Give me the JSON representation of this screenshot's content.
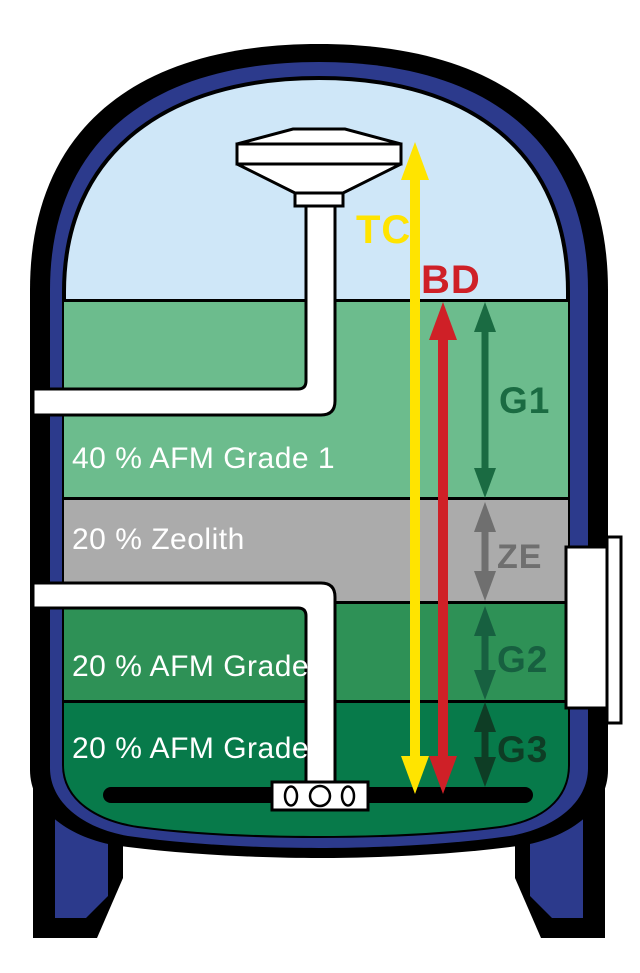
{
  "labels": {
    "tc": "TC",
    "bd": "BD",
    "g1": "G1",
    "ze": "ZE",
    "g2": "G2",
    "g3": "G3"
  },
  "layers": [
    {
      "caption": "40 % AFM Grade 1",
      "tag": "G1"
    },
    {
      "caption": "20 % Zeolith",
      "tag": "ZE"
    },
    {
      "caption": "20 % AFM Grade 2",
      "tag": "G2"
    },
    {
      "caption": "20 % AFM Grade 3",
      "tag": "G3"
    }
  ],
  "colors": {
    "vessel_wall": "#2c3a8c",
    "outline": "#000000",
    "water": "#cfe7f8",
    "layer_g1": "#6cbc8d",
    "layer_ze": "#ababab",
    "layer_g2": "#2e9156",
    "layer_g3": "#077a4a",
    "pipe": "#ffffff",
    "arrow_tc": "#ffe400",
    "arrow_bd": "#cf2027",
    "arrow_g1": "#1a6b42",
    "arrow_ze": "#6f6f6f",
    "arrow_g2": "#176040",
    "arrow_g3": "#0e3d25",
    "caption_text": "#ffffff"
  }
}
